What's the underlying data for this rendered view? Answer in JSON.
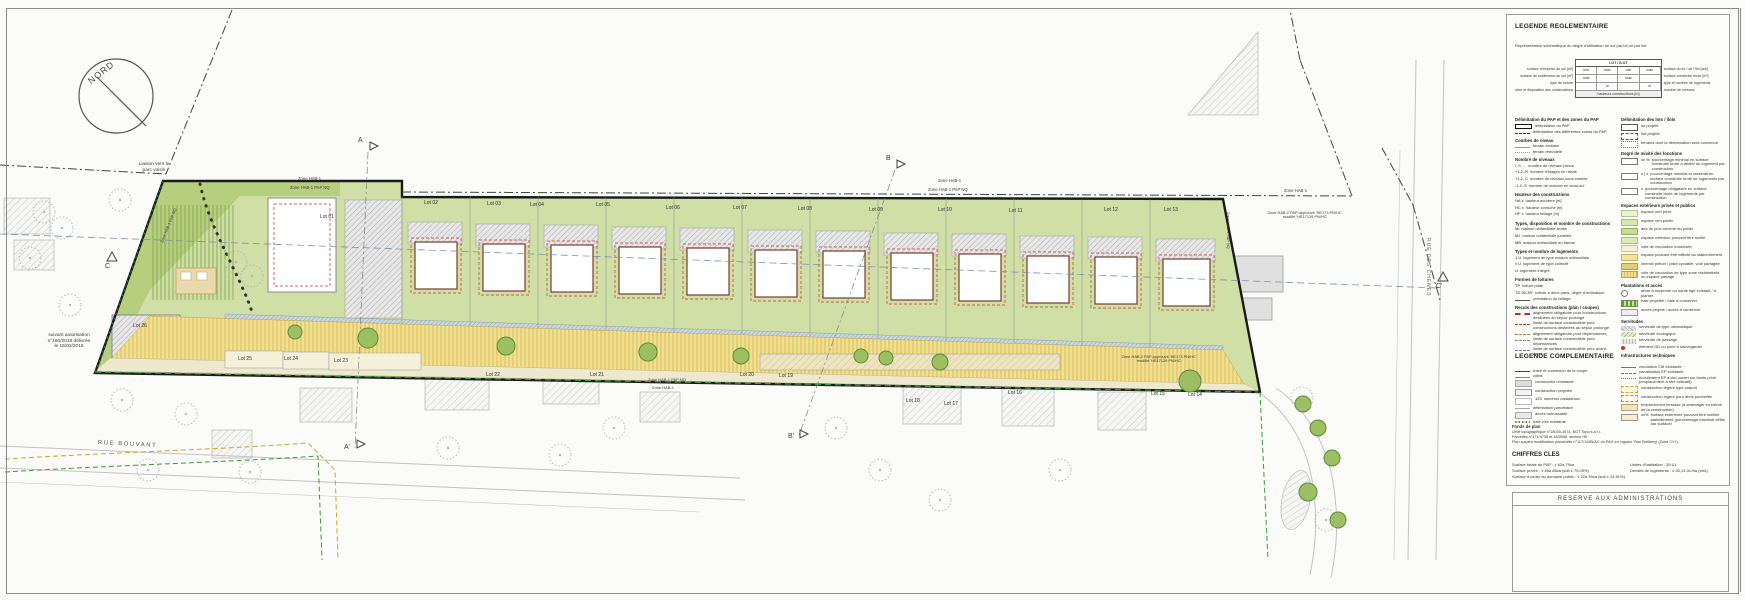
{
  "colors": {
    "site_green": "#cfdfa6",
    "park_green": "#b5cf7e",
    "road_yellow": "#f1df92",
    "building_outline": "#7a3b2f",
    "construction_limit_red": "#c0392b",
    "section_line_blue": "#7a93ad",
    "path_green": "#3a9a3a"
  },
  "map": {
    "compass": {
      "label": "NORD"
    },
    "labels": [
      {
        "text": "Liaison vers le\nparc voisin",
        "x": 126,
        "y": 162,
        "w": 56,
        "fs": 4.8,
        "ta": "center"
      },
      {
        "text": "suivant autorisation\nn°180/2018 délivrée\nle 15/02/2018",
        "x": 36,
        "y": 333,
        "w": 66,
        "fs": 4.8,
        "ta": "center"
      },
      {
        "text": "Zone HAB-1",
        "x": 298,
        "y": 177,
        "fs": 4.2
      },
      {
        "text": "Zone HAB-1 PAP NQ",
        "x": 290,
        "y": 186,
        "fs": 4.2
      },
      {
        "text": "Zone HAB-1",
        "x": 938,
        "y": 179,
        "fs": 4.2
      },
      {
        "text": "Zone HAB-1 PAP NQ",
        "x": 928,
        "y": 188,
        "fs": 4.2
      },
      {
        "text": "Zone HAB-1",
        "x": 1284,
        "y": 189,
        "fs": 4.2
      },
      {
        "text": "Zone HAB-2 PAP approuvé 'HE173 PN/HC'\nmodifié 'HE17129 PN/HC'",
        "x": 1258,
        "y": 211,
        "w": 94,
        "fs": 3.9,
        "ta": "center"
      },
      {
        "text": "Zone HAB-1 PAP NQ",
        "x": 648,
        "y": 378,
        "fs": 4
      },
      {
        "text": "Zone HAB-1",
        "x": 652,
        "y": 386,
        "fs": 4
      },
      {
        "text": "Zone HAB-2 PAP approuvé 'HE173 PN/HC'\nmodifié 'HE17129 PN/HC'",
        "x": 1112,
        "y": 355,
        "w": 94,
        "fs": 3.9,
        "ta": "center"
      },
      {
        "text": "Zone HAB-1 PAP NQ",
        "x": 1230,
        "y": 212,
        "fs": 3.9,
        "rot": 90
      },
      {
        "text": "Zone HAB-1 PAP NQ",
        "x": 160,
        "y": 242,
        "fs": 3.9,
        "rot": -68
      },
      {
        "text": "RUE BOUVANT",
        "x": 98,
        "y": 440,
        "fs": 6,
        "rot": 3,
        "ls": 1.5,
        "color": "#555"
      },
      {
        "text": "RUE DES CHENES",
        "x": 1430,
        "y": 238,
        "fs": 5,
        "rot": 90,
        "ls": 1,
        "color": "#666"
      },
      {
        "text": "A",
        "x": 358,
        "y": 137,
        "fs": 7
      },
      {
        "text": "A'",
        "x": 344,
        "y": 444,
        "fs": 7
      },
      {
        "text": "B",
        "x": 886,
        "y": 155,
        "fs": 7
      },
      {
        "text": "B'",
        "x": 788,
        "y": 433,
        "fs": 7
      },
      {
        "text": "C",
        "x": 105,
        "y": 263,
        "fs": 7
      },
      {
        "text": "C'",
        "x": 1436,
        "y": 283,
        "fs": 7
      }
    ],
    "lots": [
      {
        "n": "Lot 01",
        "x": 320,
        "y": 214
      },
      {
        "n": "Lot 02",
        "x": 424,
        "y": 200
      },
      {
        "n": "Lot 03",
        "x": 487,
        "y": 201
      },
      {
        "n": "Lot 04",
        "x": 530,
        "y": 202
      },
      {
        "n": "Lot 05",
        "x": 596,
        "y": 202
      },
      {
        "n": "Lot 06",
        "x": 666,
        "y": 205
      },
      {
        "n": "Lot 07",
        "x": 733,
        "y": 205
      },
      {
        "n": "Lot 08",
        "x": 798,
        "y": 206
      },
      {
        "n": "Lot 09",
        "x": 869,
        "y": 207
      },
      {
        "n": "Lot 10",
        "x": 938,
        "y": 207
      },
      {
        "n": "Lot 11",
        "x": 1009,
        "y": 208
      },
      {
        "n": "Lot 12",
        "x": 1104,
        "y": 207
      },
      {
        "n": "Lot 13",
        "x": 1164,
        "y": 207
      },
      {
        "n": "Lot 26",
        "x": 133,
        "y": 323
      },
      {
        "n": "Lot 25",
        "x": 238,
        "y": 356
      },
      {
        "n": "Lot 24",
        "x": 284,
        "y": 356
      },
      {
        "n": "Lot 23",
        "x": 334,
        "y": 358
      },
      {
        "n": "Lot 22",
        "x": 486,
        "y": 372
      },
      {
        "n": "Lot 21",
        "x": 590,
        "y": 372
      },
      {
        "n": "Lot 20",
        "x": 740,
        "y": 372
      },
      {
        "n": "Lot 19",
        "x": 779,
        "y": 373
      },
      {
        "n": "Lot 18",
        "x": 906,
        "y": 398
      },
      {
        "n": "Lot 17",
        "x": 944,
        "y": 401
      },
      {
        "n": "Lot 16",
        "x": 1008,
        "y": 390
      },
      {
        "n": "Lot 15",
        "x": 1151,
        "y": 391
      },
      {
        "n": "Lot 14",
        "x": 1188,
        "y": 392
      }
    ]
  },
  "legend_reg": {
    "title": "LEGENDE REGLEMENTAIRE",
    "intro": "Représentation schématique du degré d'utilisation du sol par lot ou par îlot",
    "schema": {
      "header": "LOT / ÎLOT",
      "footer": "hauteurs constructions [m]",
      "left": [
        "surface d'emprise au sol [m²]",
        "surface de scellement du sol [m²]",
        "type de toiture",
        "nbre et disposition des constructions"
      ],
      "right": [
        "surface du lot / de l'îlot [are]",
        "surface construite brute [m²]",
        "type et nombre de logements",
        "nombre de niveaux"
      ],
      "rows": [
        {
          "c": [
            "min",
            "max",
            "min",
            "max"
          ]
        },
        {
          "c": [
            "max",
            "",
            "max",
            ""
          ]
        },
        {
          "c": [
            "",
            "m",
            "",
            "m"
          ]
        }
      ]
    },
    "col_left": [
      {
        "title": "Délimitation du PAP et des zones du PAP",
        "items": [
          {
            "sw": "sw-thick",
            "label": "délimitation du PAP"
          },
          {
            "sw": "sw-zdash",
            "label": "délimitation des différentes zones du PAP"
          }
        ]
      },
      {
        "title": "Courbes de niveau",
        "items": [
          {
            "sw": "sw-lgray",
            "label": "terrain existant"
          },
          {
            "sw": "sw-dgray",
            "label": "terrain remodelé"
          }
        ]
      },
      {
        "title": "Nombre de niveaux",
        "items": [
          {
            "sw": "sw-none",
            "key": "I, II, ...",
            "label": "nombre de niveaux pleins"
          },
          {
            "sw": "sw-none",
            "key": "+1,2..R",
            "label": "nombre d'étages en retrait"
          },
          {
            "sw": "sw-none",
            "key": "+1,2..C",
            "label": "nombre de niveaux sous comble"
          },
          {
            "sw": "sw-none",
            "key": "-1,2..S",
            "label": "nombre de niveaux en sous-sol"
          }
        ]
      },
      {
        "title": "Hauteur des constructions",
        "items": [
          {
            "sw": "sw-none",
            "key": "HA x",
            "label": "hauteur acrotère [m]"
          },
          {
            "sw": "sw-none",
            "key": "HC x",
            "label": "hauteur corniche [m]"
          },
          {
            "sw": "sw-none",
            "key": "HF x",
            "label": "hauteur faîtage [m]"
          }
        ]
      },
      {
        "title": "Types, disposition et nombre de constructions",
        "items": [
          {
            "sw": "sw-none",
            "key": "MI",
            "label": "maison unifamiliale isolée"
          },
          {
            "sw": "sw-none",
            "key": "MJ",
            "label": "maison unifamiliale jumelée"
          },
          {
            "sw": "sw-none",
            "key": "MB",
            "label": "maison unifamiliale en bande"
          }
        ]
      },
      {
        "title": "Types et nombre de logements",
        "items": [
          {
            "sw": "sw-none",
            "key": "1 U",
            "label": "logement de type maison unifamiliale"
          },
          {
            "sw": "sw-none",
            "key": "x U",
            "label": "logement de type collectif"
          },
          {
            "sw": "sw-none",
            "key": "U",
            "label": "logement intégré"
          }
        ]
      },
      {
        "title": "Formes de toitures",
        "items": [
          {
            "sw": "sw-none",
            "key": "TP",
            "label": "toiture plate"
          },
          {
            "sw": "sw-none",
            "key": "TD 30-35°",
            "label": "toiture à deux pans, degré d'inclinaison"
          },
          {
            "sw": "sw-fait",
            "label": "orientation du faîtage"
          }
        ]
      },
      {
        "title": "Reculs des constructions (plan / coupes)",
        "items": [
          {
            "sw": "sw-redthick",
            "label": "alignement obligatoire pour constructions destinées au séjour prolongé"
          },
          {
            "sw": "sw-reddash",
            "label": "limite de surface constructible pour constructions destinées au séjour prolongé"
          },
          {
            "sw": "sw-ordash",
            "label": "alignement obligatoire pour dépendances"
          },
          {
            "sw": "sw-grdash",
            "label": "limite de surface constructible pour dépendances"
          },
          {
            "sw": "sw-bldash",
            "label": "limite de surface constructible pour avant-corps"
          }
        ]
      }
    ],
    "col_right": [
      {
        "title": "Délimitation des lots / îlots",
        "items": [
          {
            "sw": "sw-lotbox",
            "label": "lot projeté"
          },
          {
            "sw": "sw-ilotbox",
            "label": "îlot projeté"
          },
          {
            "sw": "sw-borne",
            "label": "terrains dont la démarcation sera convenue"
          }
        ]
      },
      {
        "title": "Degré de mixité des fonctions",
        "items": [
          {
            "sw": "sw-pctbox",
            "key": "xx %",
            "label": "pourcentage minimal en surface construite brute à dédier au logement par construction"
          },
          {
            "sw": "sw-pctbox2",
            "key": "x | x",
            "label": "pourcentage minimal et maximal en surface construite brute de logements par construction"
          },
          {
            "sw": "sw-pctsm",
            "key": "x",
            "label": "pourcentage obligatoire en surface construite brute de logements par construction"
          }
        ]
      },
      {
        "title": "Espaces extérieurs privés et publics",
        "items": [
          {
            "sw": "sw-g1",
            "label": "espace vert privé"
          },
          {
            "sw": "sw-g2",
            "label": "espace vert public"
          },
          {
            "sw": "sw-g3",
            "label": "aire de jeux ouverte au public"
          },
          {
            "sw": "sw-g4",
            "label": "espace extérieur pouvant être scellé"
          },
          {
            "sw": "sw-y1",
            "label": "voie de circulation motorisée"
          },
          {
            "sw": "sw-y2",
            "label": "espace pouvant être affecté au stationnement"
          },
          {
            "sw": "sw-y3",
            "label": "chemin piéton / piste cyclable, voie partagée"
          },
          {
            "sw": "sw-yh",
            "label": "voie de circulation de type zone résidentielle ou espace partagé"
          }
        ]
      },
      {
        "title": "Plantations et accès",
        "items": [
          {
            "sw": "sw-trees",
            "label": "arbre à moyenne ou haute tige existant / à planter"
          },
          {
            "sw": "sw-haies",
            "label": "haie projetée / haie à conserver"
          },
          {
            "sw": "sw-acces",
            "label": "accès projeté / accès à conserver"
          }
        ]
      },
      {
        "title": "Servitudes",
        "items": [
          {
            "sw": "sw-servU",
            "label": "servitude de type urbanistique"
          },
          {
            "sw": "sw-servE",
            "label": "servitude écologique"
          },
          {
            "sw": "sw-servP",
            "label": "servitude de passage"
          },
          {
            "sw": "sw-reddot",
            "label": "élément DD ou point à sauvegarder"
          }
        ]
      },
      {
        "title": "Infrastructures techniques",
        "items": [
          {
            "sw": "sw-pipes",
            "label": "collecteur à ciel ouvert pour eaux de pluie"
          },
          {
            "sw": "sw-canp",
            "label": "canalisation pour eaux pluviales"
          },
          {
            "sw": "sw-canu",
            "label": "canalisation pour eaux usées"
          },
          {
            "sw": "sw-fosse",
            "label": "fossé ouvert pour eaux pluviales"
          }
        ]
      }
    ]
  },
  "legend_comp": {
    "title": "LEGENDE COMPLEMENTAIRE",
    "col_left": [
      {
        "title": "",
        "items": [
          {
            "sw": "sw-coupe",
            "label": "tracé et connexion de la coupe"
          },
          {
            "sw": "sw-cote",
            "label": "côtes"
          },
          {
            "sw": "sw-cexist",
            "label": "construction existante"
          },
          {
            "sw": "sw-cproj",
            "label": "construction projetée"
          },
          {
            "sw": "sw-ncad",
            "key": "123",
            "label": "numéros cadastraux"
          },
          {
            "sw": "sw-parc",
            "label": "délimitation parcellaire"
          },
          {
            "sw": "sw-acc",
            "label": "accès carrossable"
          },
          {
            "sw": "sw-haie",
            "label": "haie vive existante"
          },
          {
            "sw": "sw-niv",
            "label": "courbes de niveau [m NN]"
          }
        ]
      }
    ],
    "col_right": [
      {
        "title": "",
        "items": [
          {
            "sw": "sw-gline",
            "label": "circulation CM existante"
          },
          {
            "sw": "sw-gdash",
            "label": "canalisation EP existante"
          },
          {
            "sw": "sw-gdots",
            "label": "écoulement EP à ciel ouvert sur fonds privé (emplacement à titre indicatif)"
          },
          {
            "sw": "sw-ydashbox",
            "label": "construction légère type carport"
          },
          {
            "sw": "sw-ydashbox2",
            "label": "construction légère pour abris poubelles"
          },
          {
            "sw": "sw-tan",
            "label": "emplacement terrasse (à aménager en toiture de la construction)"
          },
          {
            "sw": "sw-pct",
            "key": "xx%",
            "label": "surface extérieure pouvant être scellée partiellement (pourcentage maximal défini par surface)"
          },
          {
            "sw": "sw-gped",
            "label": "accès piéton d'une largeur de 2,50 m à garantir (emplacement indicatif)"
          }
        ]
      }
    ]
  },
  "fonds": {
    "title": "Fonds de plan",
    "lines": [
      "Levé topographique n°18030-4974, BGT Topo s.à r.l.",
      "Parcelles n°471/4735 et 1835/69, section HE",
      "Plan suivant modification ponctuelle n°117/1/MN/AC du PAG en vigueur 'Rue Bréiberg' (Zone C1+)"
    ]
  },
  "chiffres": {
    "title": "CHIFFRES CLES",
    "left": [
      "Surface totale du PAP : ± 62a 79ca",
      "Surface privée : ± 46a 86ca (soit ± 75,09%)",
      "Surface à céder au domaine public : ± 22a 39ca (soit ± 24,91%)"
    ],
    "right": [
      "Unités d'habitation : 26 UL",
      "Densité de logements : ± 26,13 UL/ha (brut)"
    ]
  },
  "reserve": {
    "title": "RESERVE AUX ADMINISTRATIONS"
  }
}
